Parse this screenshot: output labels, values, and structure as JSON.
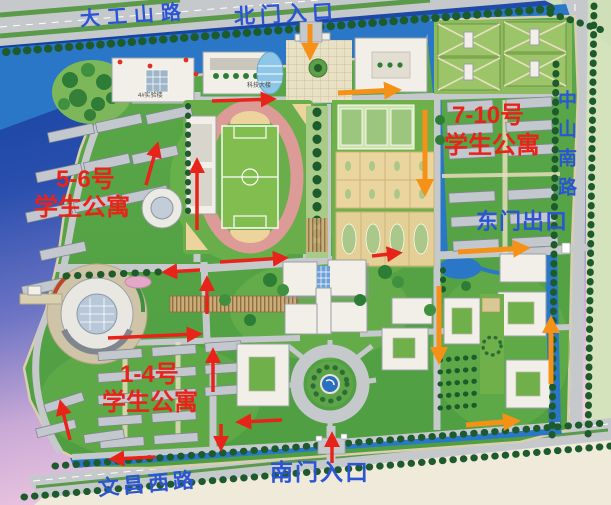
{
  "labels": {
    "road_top": "大工山路",
    "gate_north": "北门入口",
    "road_right": "中山南路",
    "gate_east": "东门出口",
    "gate_south": "南门入口",
    "road_bottom": "文昌西路",
    "dorm_east_1": "7-10号",
    "dorm_east_2": "学生公寓",
    "dorm_west_1": "5-6号",
    "dorm_west_2": "学生公寓",
    "dorm_south_1": "1-4号",
    "dorm_south_2": "学生公寓",
    "bldg_lab": "4#实验楼",
    "bldg_science": "科技大楼"
  },
  "colors": {
    "road_label_blue": "#2b55d4",
    "dorm_label_red": "#e8231a",
    "route_red": "#e8231a",
    "route_orange": "#f59116",
    "water_blue": "#2a77c8",
    "campus_green": "#57a545",
    "track_pink": "#dc9b97",
    "road_gray": "#c6c9cc",
    "court_tan": "#e9d49e"
  }
}
